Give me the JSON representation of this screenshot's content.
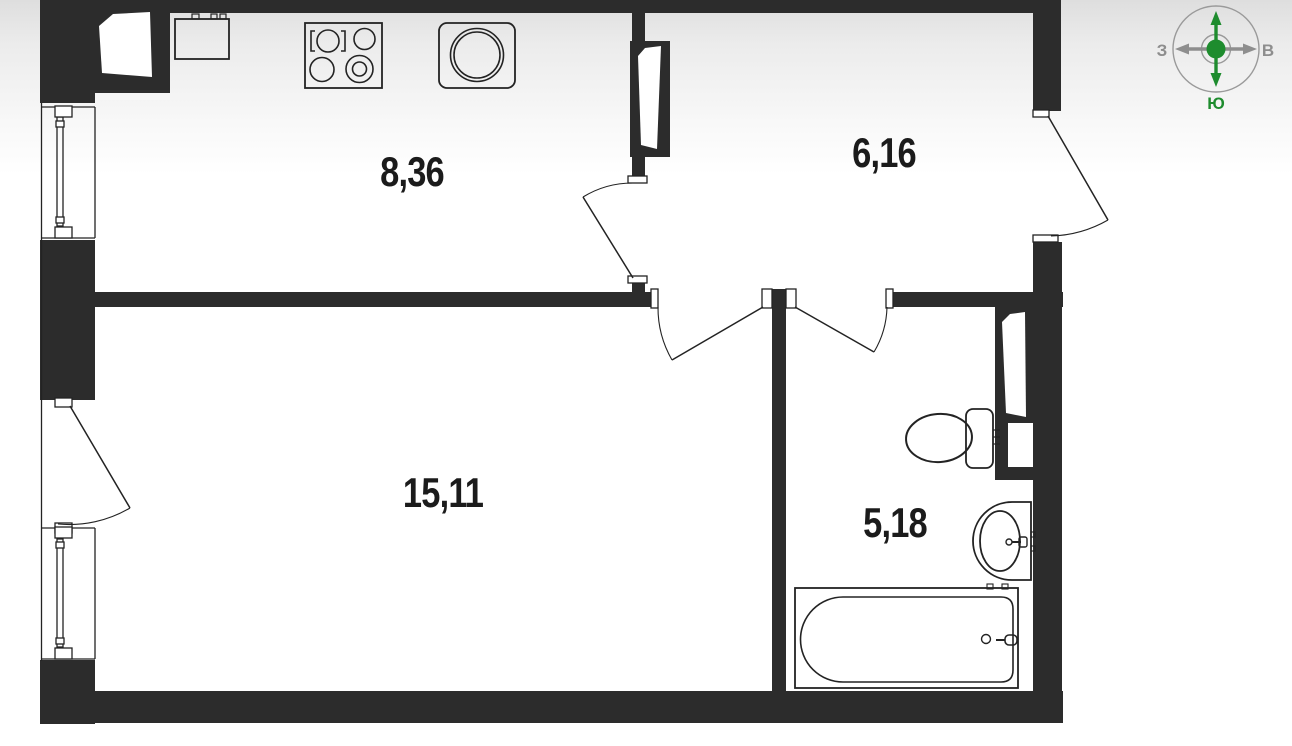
{
  "page": {
    "type": "apartment-floor-plan",
    "language": "ru"
  },
  "rooms": {
    "kitchen": {
      "area_label": "8,36"
    },
    "hallway": {
      "area_label": "6,16"
    },
    "living_room": {
      "area_label": "15,11"
    },
    "bathroom": {
      "area_label": "5,18"
    }
  },
  "compass": {
    "north_label": "С",
    "south_label": "Ю",
    "west_label": "З",
    "east_label": "В",
    "north_south_color": "#1e8c2e",
    "west_east_color": "#8e8e8e"
  },
  "colors": {
    "wall": "#2c2c2c",
    "line": "#232323",
    "label_text": "#1b1b1b",
    "background_top": "#dedede",
    "background_bottom": "#ffffff"
  },
  "fixtures": [
    "kitchen-sink",
    "cooktop",
    "washing-machine",
    "toilet",
    "washbasin",
    "bathtub",
    "vent-shaft-kitchen",
    "vent-shaft-hallway",
    "vent-shaft-bathroom",
    "window-kitchen",
    "window-living-room",
    "balcony-door",
    "door-kitchen",
    "door-living-room",
    "door-bathroom",
    "entrance-door"
  ]
}
